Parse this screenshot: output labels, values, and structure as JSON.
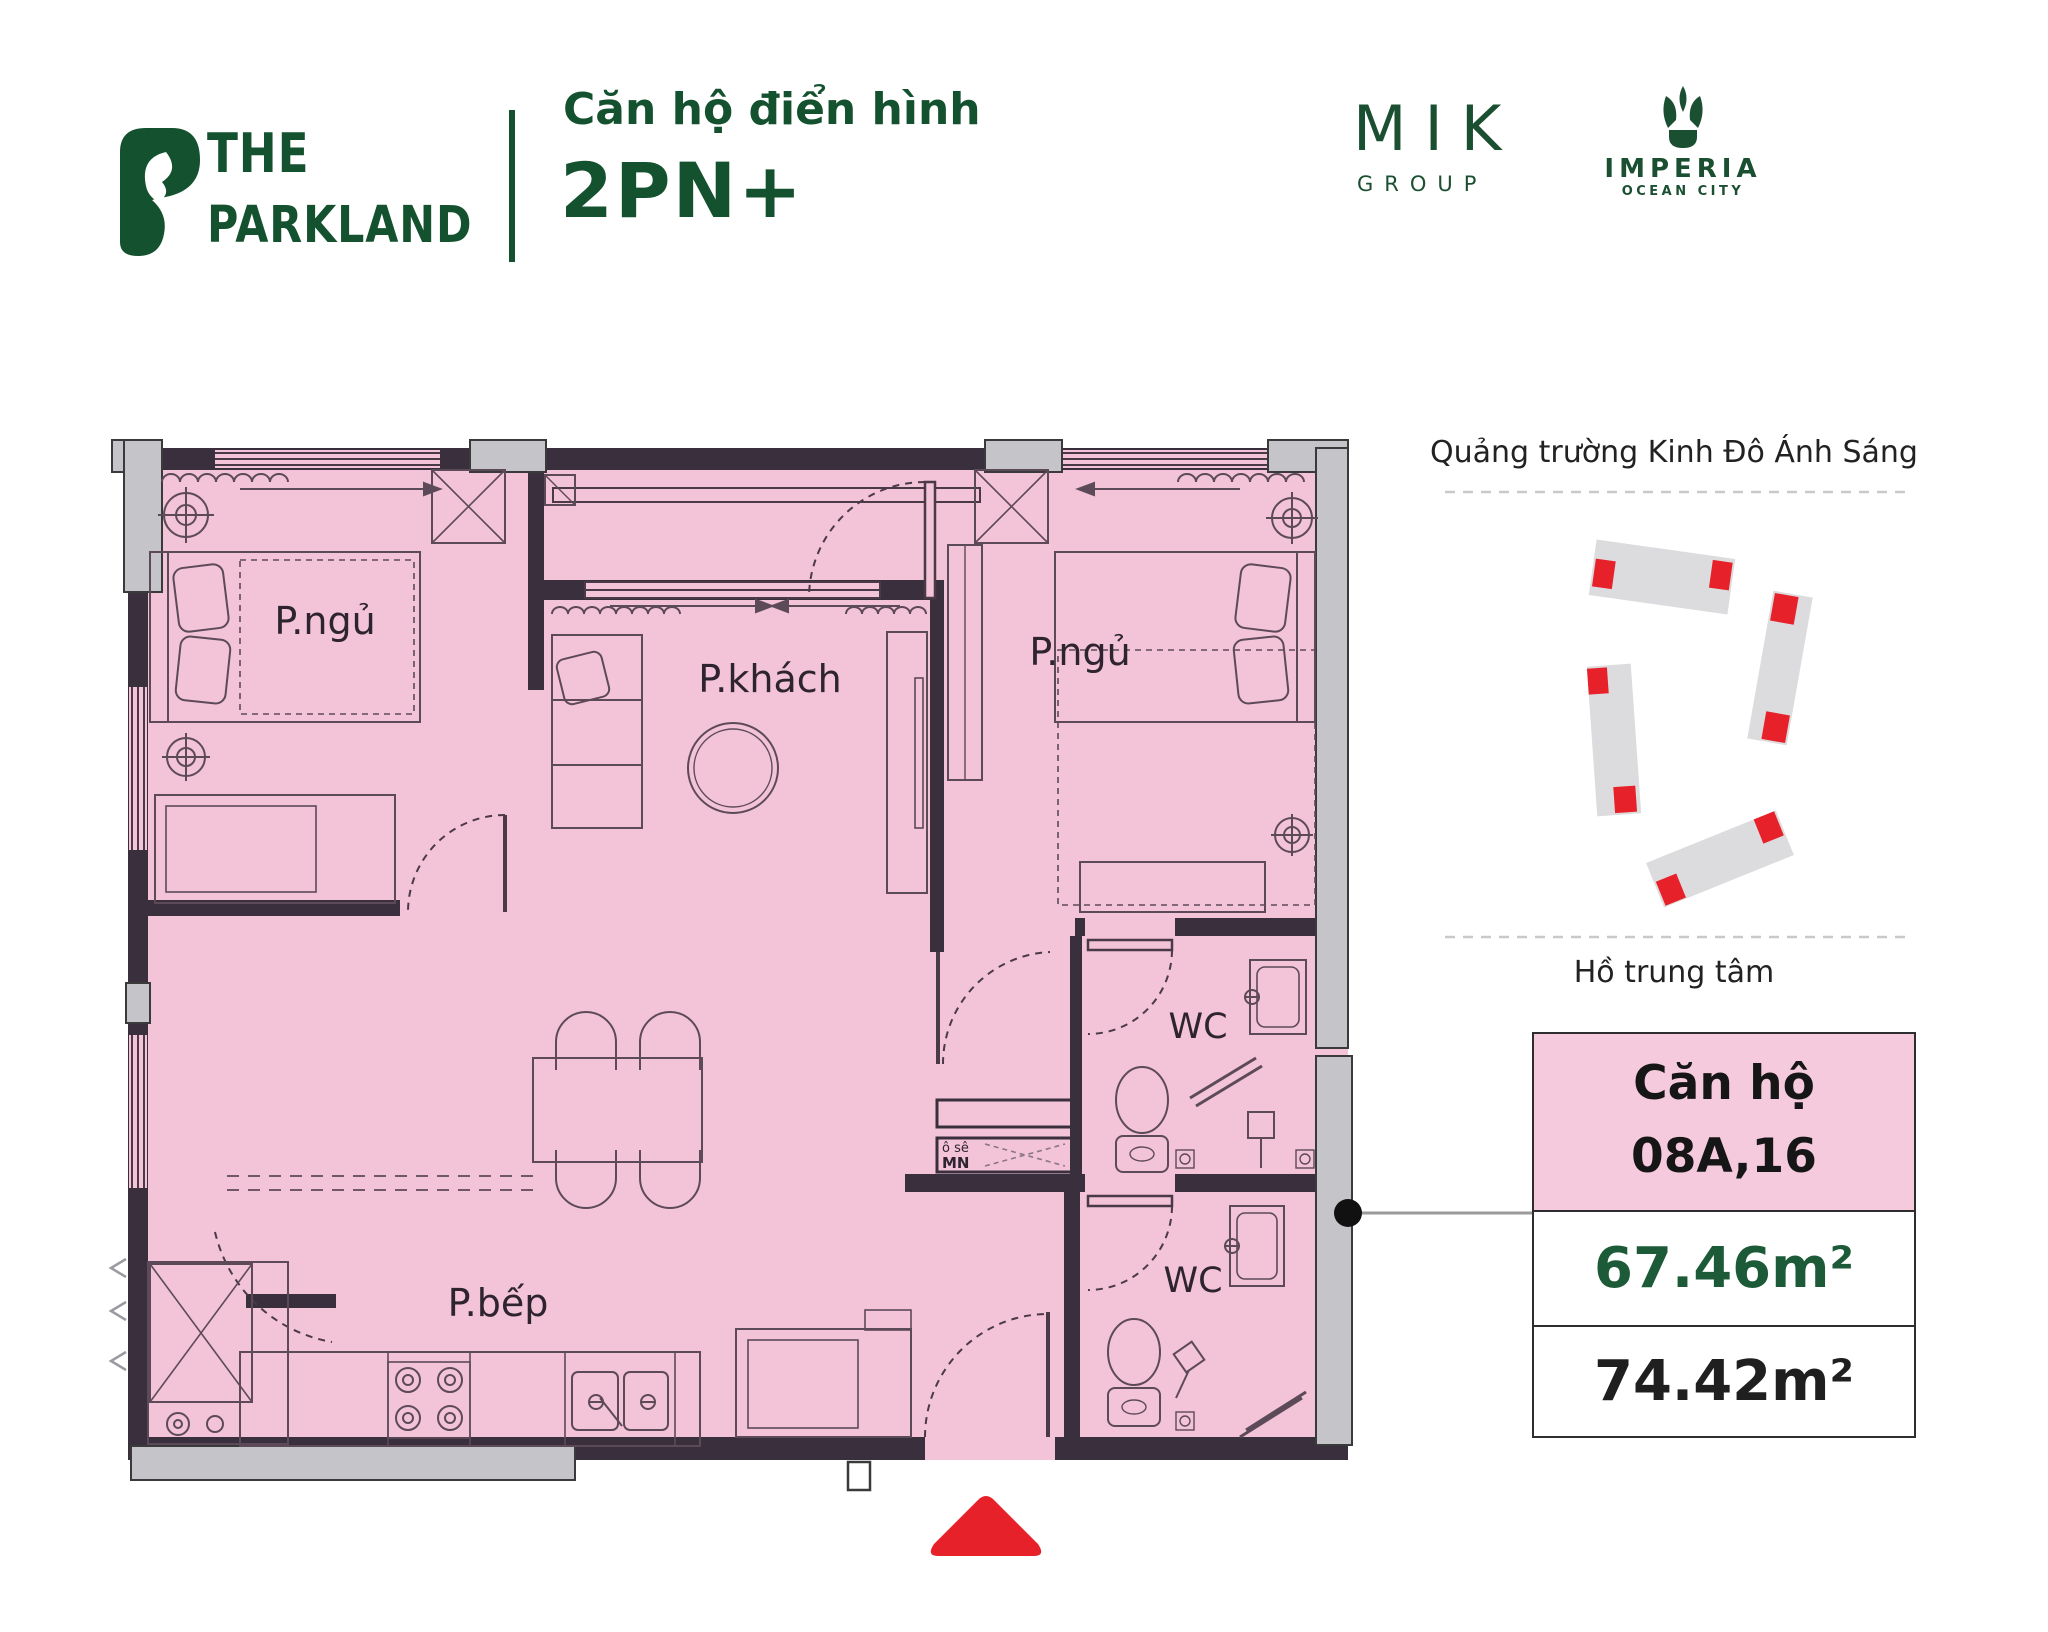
{
  "header": {
    "brand_line1": "THE",
    "brand_line2": "PARKLAND",
    "subtitle": "Căn hộ điển hình",
    "apartment_type": "2PN+",
    "mik": "MIK",
    "mik_sub": "GROUP",
    "imperia": "IMPERIA",
    "imperia_sub": "OCEAN CITY"
  },
  "plan": {
    "bedroom1": "P.ngủ",
    "living": "P.khách",
    "bedroom2": "P.ngủ",
    "kitchen": "P.bếp",
    "wc1": "WC",
    "wc2": "WC",
    "shaft_top": "ô sê",
    "shaft_bottom": "MN"
  },
  "site": {
    "square_label": "Quảng trường Kinh Đô Ánh Sáng",
    "lake_label": "Hồ trung tâm"
  },
  "info_box": {
    "label": "Căn hộ",
    "unit": "08A,16",
    "area_net": "67.46m²",
    "area_gross": "74.42m²"
  },
  "colors": {
    "brand_green": "#14512e",
    "area_green": "#1d5b38",
    "plan_pink": "#f3c3d7",
    "info_pink": "#f5cadd",
    "wall_dark": "#3a2f3c",
    "window_gray": "#c5c4c9",
    "marker_red": "#e62129",
    "furniture_line": "#5d4a59"
  }
}
